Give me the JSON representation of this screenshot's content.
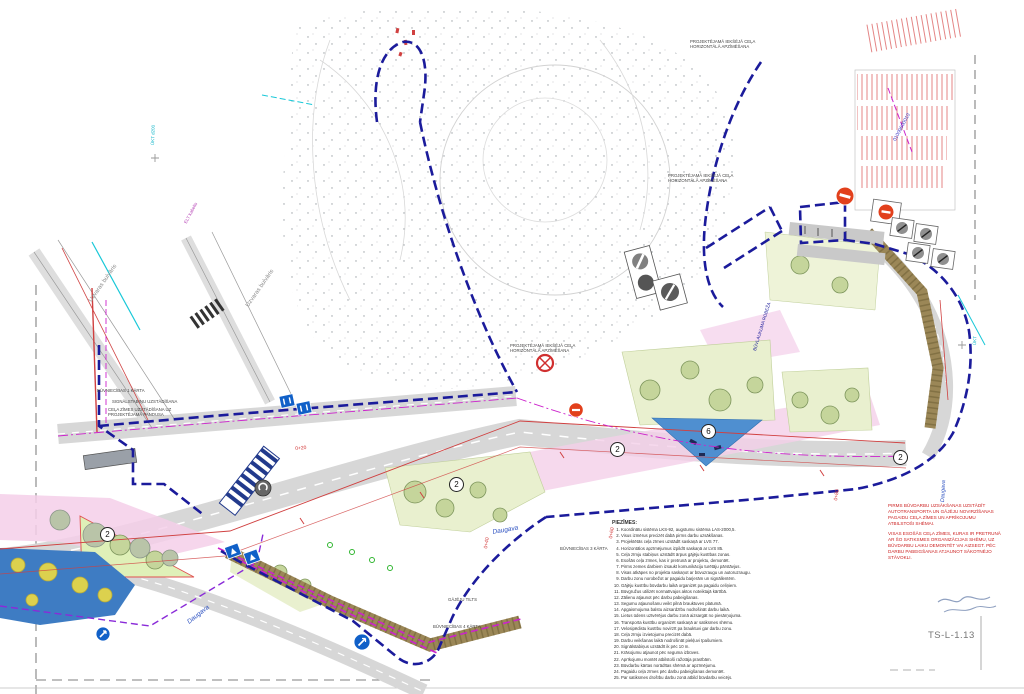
{
  "sheet": {
    "number": "TS-L-1.13"
  },
  "colors": {
    "boundary_navy": "#1b1b9b",
    "utility_magenta": "#cc22cc",
    "danger_red": "#d03030",
    "water_blue": "#3e7cc3",
    "lawn_green": "#e9f0cf",
    "area_pink": "#f4cfe9",
    "embankment_brown": "#9b8757",
    "utility_cyan": "#19c8d8",
    "road_grey": "#d7d7d7"
  },
  "labels": {
    "uzvaras1": "Uzvaras bulvāris",
    "uzvaras2": "Uzvaras bulvāris",
    "daugava1": "Daugava",
    "daugava2": "Daugava",
    "daugava3": "Daugava",
    "gajeju_tilts": "GĀJĒJU TILTS",
    "buvn1": "BŪVNIECĪBAS 1 KĀRTA",
    "buvn3": "BŪVNIECĪBAS 3 KĀRTA",
    "buvn4": "BŪVNIECĪBAS 4 KĀRTA",
    "signalstabini": "SIGNĀLSTABIŅU UZSTĀDĪŠANA",
    "celazimes": "CEĻA ZĪMES UZSTĀDĪŠANA UZ PROJEKTĒJAMĀ PANDUSA",
    "proj_horiz": "PROJEKTĒJAMĀ IEKŠĒJĀ CEĻA HORIZONTĀLĀ APZĪMĒŠANA",
    "kadastrs": "01009600010",
    "buvlaukuma": "BŪVLAUKUMA ROBEŽA",
    "ukt1": "ŪKT d200",
    "ukt2": "ŪKT",
    "elt": "ELT kabelis"
  },
  "markers": [
    {
      "n": "2"
    },
    {
      "n": "2"
    },
    {
      "n": "2"
    },
    {
      "n": "6"
    },
    {
      "n": "2"
    }
  ],
  "chainage": [
    {
      "label": "0+20"
    },
    {
      "label": "0+40"
    },
    {
      "label": "0+60"
    },
    {
      "label": "0+80"
    }
  ],
  "red_note": {
    "p1": "PIRMS BŪVDARBU UZSĀKŠANAS UZSTĀDĪT AUTOTRANSPORTA UN GĀJĒJU NOVIRZĪŠANAS PAGAIDU CEĻA ZĪMES UN APRĪKOJUMU ATBILSTOŠI SHĒMAI.",
    "p2": "VISAS ESOŠĀS CEĻA ZĪMES, KURAS IR PRETRUNĀ AR ŠO SATIKSMES ORGANIZĀCIJAS SHĒMU, UZ BŪVDARBU LAIKU DEMONTĒT VAI AIZSEGT. PĒC DARBU PABEIGŠANAS ATJAUNOT SĀKOTNĒJO STĀVOKLI."
  },
  "notes": {
    "title": "PIEZĪMES:",
    "items": [
      "Koordinātu sistēma LKS-92, augstumu sistēma LAS-2000,5.",
      "Visus izmērus precizēt dabā pirms darbu uzsākšanas.",
      "Projektētās ceļa zīmes uzstādīt saskaņā ar LVS 77.",
      "Horizontālos apzīmējumus izpildīt saskaņā ar LVS 85.",
      "Ceļa zīmju stabiņus uzstādīt ārpus gājēju kustības zonas.",
      "Esošās ceļa zīmes, kas ir pretrunā ar projektu, demontēt.",
      "Pirms zemes darbiem izsaukt komunikāciju turētāju pārstāvjus.",
      "Visas atkāpes no projekta saskaņot ar būvuzraugu un autoruzraugu.",
      "Darbu zonu norobežot ar pagaidu barjerām un signāllentēm.",
      "Gājēju kustību būvdarbu laikā organizēt pa pagaidu celiņiem.",
      "Būvgružus utilizēt normatīvajos aktos noteiktajā kārtībā.",
      "Zālienu atjaunot pēc darbu pabeigšanas.",
      "Segumu atjaunošanu veikt pilnā brauktuves platumā.",
      "Apgaismojuma balstu aizsardzību nodrošināt darbu laikā.",
      "Lietus ūdens uztvērējus darbu zonā aizsargāt no piesārņojuma.",
      "Transporta kustību organizēt saskaņā ar satiksmes shēmu.",
      "Velosipēdistu kustību novirzīt pa brauktuvi gar darbu zonu.",
      "Ceļa zīmju izvietojumu precizēt dabā.",
      "Darbu veikšanas laikā nodrošināt piekļuvi īpašumiem.",
      "Signālstabiņus uzstādīt ik pēc 10 m.",
      "Krāsojumu atjaunot pēc seguma izbūves.",
      "Aprīkojumu montēt atbilstoši ražotāja prasībām.",
      "Būvdarbu kārtas norādītas shēmā ar apzīmējumu.",
      "Pagaidu ceļa zīmes pēc darbu pabeigšanas demontēt.",
      "Par satiksmes drošību darbu zonā atbild būvdarbu veicējs."
    ]
  }
}
